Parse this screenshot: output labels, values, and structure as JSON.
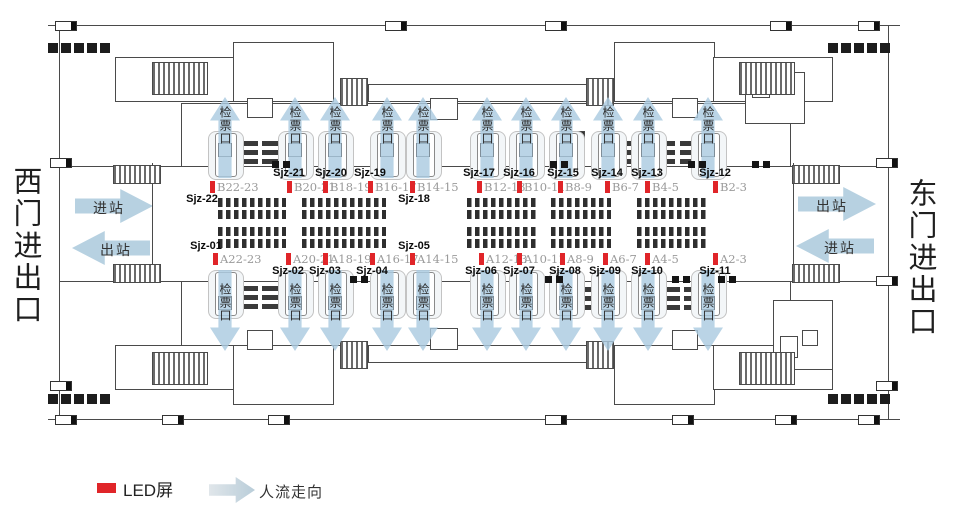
{
  "station": {
    "west_gate_label": "西门进出口",
    "east_gate_label": "东门进出口"
  },
  "flows": {
    "west_top": "进站",
    "west_bottom": "出站",
    "east_top": "出站",
    "east_bottom": "进站"
  },
  "gates": {
    "label": "检票口",
    "columns_x": [
      225,
      295,
      335,
      387,
      423,
      487,
      526,
      566,
      608,
      648,
      708
    ]
  },
  "led_rows": {
    "b": [
      {
        "screen": "Sjz-22",
        "bay": "B22-23",
        "x": 210,
        "side": "below",
        "dx": -10
      },
      {
        "screen": "Sjz-21",
        "bay": "B20-21",
        "x": 287,
        "side": "above",
        "dx": 0
      },
      {
        "screen": "Sjz-20",
        "bay": "B18-19",
        "x": 323,
        "side": "above",
        "dx": 6
      },
      {
        "screen": "Sjz-19",
        "bay": "B16-17",
        "x": 368,
        "side": "above",
        "dx": 0
      },
      {
        "screen": "Sjz-18",
        "bay": "B14-15",
        "x": 410,
        "side": "below",
        "dx": 2
      },
      {
        "screen": "Sjz-17",
        "bay": "B12-13",
        "x": 477,
        "side": "above",
        "dx": 0
      },
      {
        "screen": "Sjz-16",
        "bay": "B10-11",
        "x": 517,
        "side": "above",
        "dx": 0
      },
      {
        "screen": "Sjz-15",
        "bay": "B8-9",
        "x": 558,
        "side": "above",
        "dx": 3
      },
      {
        "screen": "Sjz-14",
        "bay": "B6-7",
        "x": 605,
        "side": "above",
        "dx": 0
      },
      {
        "screen": "Sjz-13",
        "bay": "B4-5",
        "x": 645,
        "side": "above",
        "dx": 0
      },
      {
        "screen": "Sjz-12",
        "bay": "B2-3",
        "x": 713,
        "side": "above",
        "dx": 0
      }
    ],
    "a": [
      {
        "screen": "Sjz-01",
        "bay": "A22-23",
        "x": 213,
        "side": "above",
        "dx": -9
      },
      {
        "screen": "Sjz-02",
        "bay": "A20-21",
        "x": 286,
        "side": "below",
        "dx": 0
      },
      {
        "screen": "Sjz-03",
        "bay": "A18-19",
        "x": 323,
        "side": "below",
        "dx": 0
      },
      {
        "screen": "Sjz-04",
        "bay": "A16-17",
        "x": 370,
        "side": "below",
        "dx": 0
      },
      {
        "screen": "Sjz-05",
        "bay": "A14-15",
        "x": 410,
        "side": "above",
        "dx": 2
      },
      {
        "screen": "Sjz-06",
        "bay": "A12-13",
        "x": 479,
        "side": "below",
        "dx": 0
      },
      {
        "screen": "Sjz-07",
        "bay": "A10-11",
        "x": 517,
        "side": "below",
        "dx": 0
      },
      {
        "screen": "Sjz-08",
        "bay": "A8-9",
        "x": 560,
        "side": "below",
        "dx": 3
      },
      {
        "screen": "Sjz-09",
        "bay": "A6-7",
        "x": 603,
        "side": "below",
        "dx": 0
      },
      {
        "screen": "Sjz-10",
        "bay": "A4-5",
        "x": 645,
        "side": "below",
        "dx": 0
      },
      {
        "screen": "Sjz-11",
        "bay": "A2-3",
        "x": 713,
        "side": "below",
        "dx": 0
      }
    ]
  },
  "legend": {
    "led": "LED屏",
    "flow": "人流走向"
  },
  "colors": {
    "led_red": "#e02529",
    "flow_blue": "#b7d1e1",
    "bay_text": "#9a9a9a"
  }
}
